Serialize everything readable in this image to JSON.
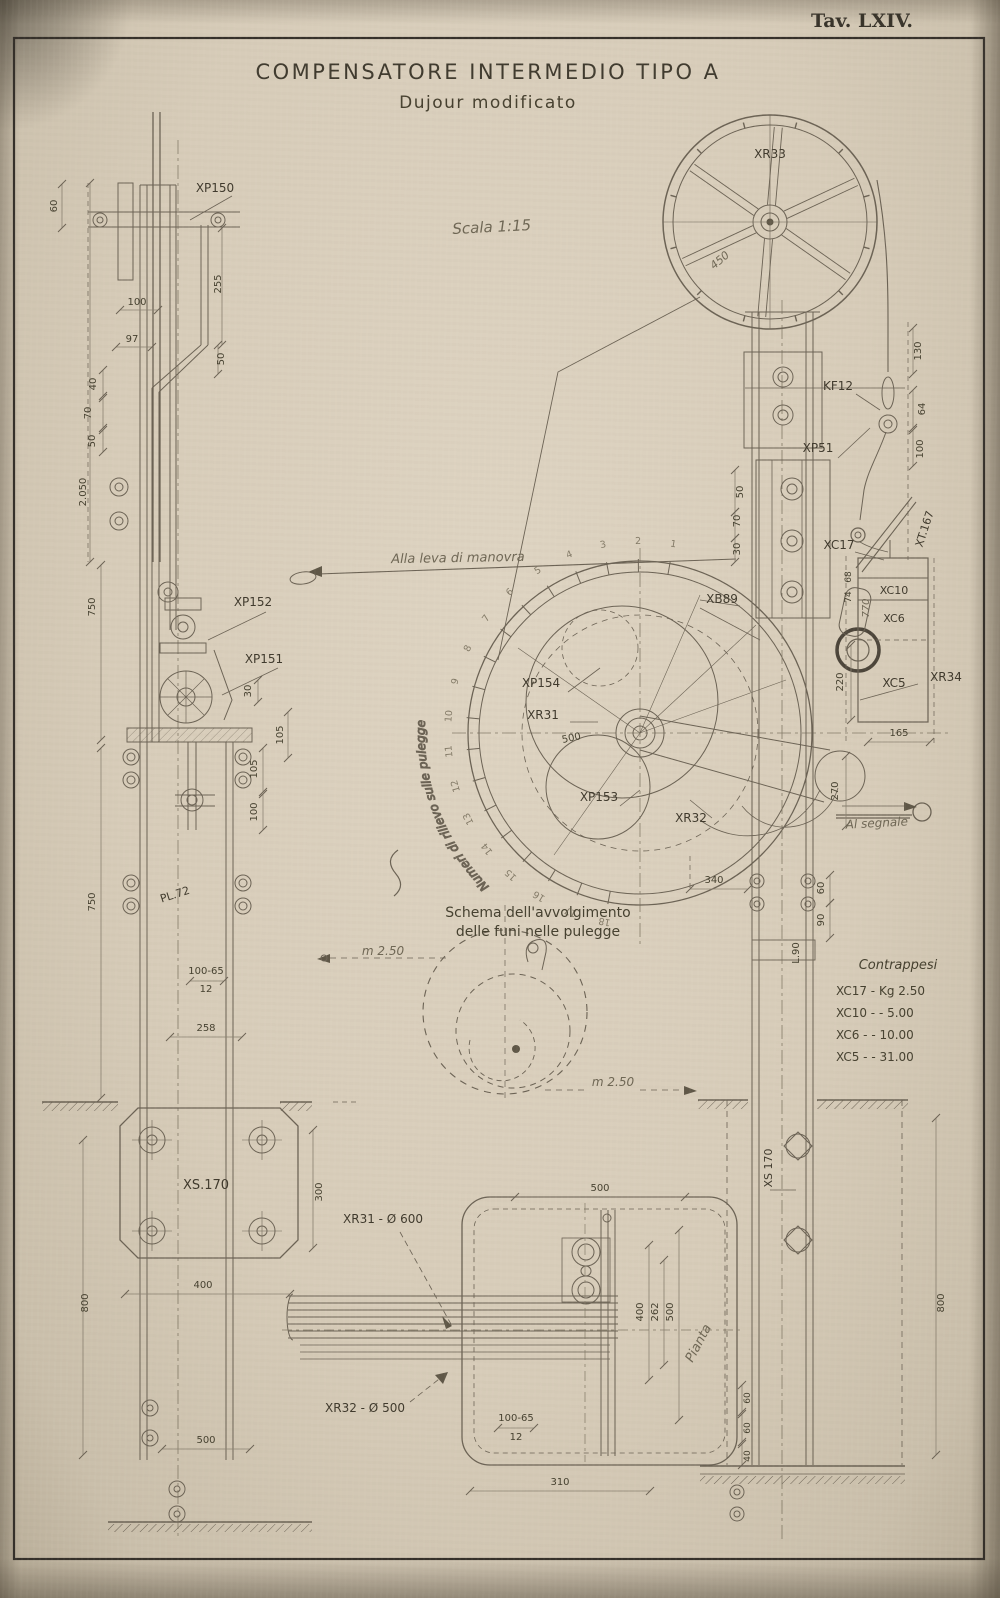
{
  "plate": {
    "number": "Tav. LXIV."
  },
  "title": {
    "line1": "COMPENSATORE INTERMEDIO TIPO A",
    "line2": "Dujour modificato",
    "scale_note": "Scala 1:15"
  },
  "colors": {
    "paper": "#d7ccb9",
    "ink": "#5f5747",
    "heavy": "#4c453a",
    "dim": "#837a67",
    "text": "#45402f",
    "frame": "#35302a"
  },
  "dial": {
    "center_x": 640,
    "center_y": 733,
    "start_angle_deg": 80,
    "step_deg": 10.55,
    "numbers": [
      "1",
      "2",
      "3",
      "4",
      "5",
      "6",
      "7",
      "8",
      "9",
      "10",
      "11",
      "12",
      "13",
      "14",
      "15",
      "16",
      "17",
      "18"
    ],
    "curved_label": "Numeri di rilievo sulle pulegge"
  },
  "contrappesi": {
    "title": "Contrappesi",
    "items": [
      {
        "code": "XC17",
        "value": "Kg 2.50"
      },
      {
        "code": "XC10",
        "value": "-  5.00"
      },
      {
        "code": "XC6",
        "value": "-  10.00"
      },
      {
        "code": "XC5",
        "value": "-  31.00"
      }
    ]
  },
  "labels": [
    {
      "n": "label-xp150",
      "t": "XP150",
      "x": 215,
      "y": 192,
      "s": 12,
      "c": "c"
    },
    {
      "n": "dim-60-left-top",
      "t": "60",
      "x": 57,
      "y": 206,
      "r": -90,
      "s": 10,
      "l": [
        62,
        184,
        62,
        228
      ]
    },
    {
      "n": "dim-255",
      "t": "255",
      "x": 221,
      "y": 284,
      "r": -90,
      "s": 10,
      "l": [
        222,
        228,
        222,
        345
      ]
    },
    {
      "n": "dim-100-left",
      "t": "100",
      "x": 137,
      "y": 305,
      "s": 10,
      "l": [
        120,
        310,
        158,
        310
      ]
    },
    {
      "n": "dim-97",
      "t": "97",
      "x": 132,
      "y": 342,
      "s": 10,
      "l": [
        116,
        347,
        152,
        347
      ]
    },
    {
      "n": "dim-50-a",
      "t": "50",
      "x": 224,
      "y": 359,
      "r": -90,
      "s": 10,
      "l": [
        218,
        345,
        218,
        374
      ]
    },
    {
      "n": "dim-40-a",
      "t": "40",
      "x": 96,
      "y": 384,
      "r": -90,
      "s": 10,
      "l": [
        103,
        370,
        103,
        396
      ]
    },
    {
      "n": "dim-70-a",
      "t": "70",
      "x": 91,
      "y": 413,
      "r": -90,
      "s": 10,
      "l": [
        103,
        398,
        103,
        428
      ]
    },
    {
      "n": "dim-50-b",
      "t": "50",
      "x": 95,
      "y": 441,
      "r": -90,
      "s": 10,
      "l": [
        103,
        430,
        103,
        452
      ]
    },
    {
      "n": "dim-2050",
      "t": "2.050",
      "x": 86,
      "y": 492,
      "r": -90,
      "s": 10,
      "l": [
        90,
        183,
        90,
        562
      ]
    },
    {
      "n": "dim-750-upper",
      "t": "750",
      "x": 95,
      "y": 607,
      "r": -90,
      "s": 10,
      "l": [
        101,
        565,
        101,
        740
      ]
    },
    {
      "n": "label-xp152",
      "t": "XP152",
      "x": 253,
      "y": 606,
      "s": 12,
      "c": "c"
    },
    {
      "n": "label-xp151",
      "t": "XP151",
      "x": 264,
      "y": 663,
      "s": 12,
      "c": "c"
    },
    {
      "n": "dim-30-mid",
      "t": "30",
      "x": 251,
      "y": 691,
      "r": -90,
      "s": 10,
      "l": [
        258,
        680,
        258,
        702
      ]
    },
    {
      "n": "dim-105-a",
      "t": "105",
      "x": 283,
      "y": 735,
      "r": -90,
      "s": 10,
      "l": [
        288,
        712,
        288,
        758
      ]
    },
    {
      "n": "dim-105-b",
      "t": "105",
      "x": 257,
      "y": 769,
      "r": -90,
      "s": 10,
      "l": [
        263,
        748,
        263,
        792
      ]
    },
    {
      "n": "dim-100-b",
      "t": "100",
      "x": 257,
      "y": 812,
      "r": -90,
      "s": 10,
      "l": [
        263,
        794,
        263,
        830
      ]
    },
    {
      "n": "dim-750-lower",
      "t": "750",
      "x": 95,
      "y": 902,
      "r": -90,
      "s": 10,
      "l": [
        101,
        748,
        101,
        1098
      ]
    },
    {
      "n": "label-pl72",
      "t": "PL.72",
      "x": 176,
      "y": 898,
      "r": -18,
      "s": 11,
      "c": "c"
    },
    {
      "n": "dim-profile-left-top",
      "t": "100-65",
      "x": 206,
      "y": 974,
      "s": 10,
      "l": [
        190,
        981,
        224,
        981
      ]
    },
    {
      "n": "dim-profile-left-bottom",
      "t": "12",
      "x": 206,
      "y": 992,
      "s": 10
    },
    {
      "n": "dim-258",
      "t": "258",
      "x": 206,
      "y": 1031,
      "s": 10,
      "l": [
        170,
        1037,
        242,
        1037
      ]
    },
    {
      "n": "label-xs170-plate",
      "t": "XS.170",
      "x": 206,
      "y": 1189,
      "s": 13,
      "c": "c"
    },
    {
      "n": "dim-300",
      "t": "300",
      "x": 322,
      "y": 1192,
      "r": -90,
      "s": 10,
      "l": [
        313,
        1130,
        313,
        1248
      ]
    },
    {
      "n": "dim-400-left",
      "t": "400",
      "x": 203,
      "y": 1288,
      "s": 10,
      "l": [
        125,
        1294,
        290,
        1294
      ]
    },
    {
      "n": "dim-800-left",
      "t": "800",
      "x": 88,
      "y": 1303,
      "r": -90,
      "s": 10,
      "l": [
        83,
        1140,
        83,
        1455
      ]
    },
    {
      "n": "dim-500-left-bottom",
      "t": "500",
      "x": 206,
      "y": 1443,
      "s": 10,
      "l": [
        162,
        1449,
        250,
        1449
      ]
    },
    {
      "n": "note-alla-leva",
      "t": "Alla leva di manovra",
      "x": 458,
      "y": 562,
      "s": 13,
      "i": 1,
      "r": -1
    },
    {
      "n": "label-xb89",
      "t": "XB89",
      "x": 722,
      "y": 603,
      "s": 12,
      "c": "c"
    },
    {
      "n": "label-xp154",
      "t": "XP154",
      "x": 541,
      "y": 687,
      "s": 12,
      "c": "c"
    },
    {
      "n": "label-xr31",
      "t": "XR31",
      "x": 543,
      "y": 719,
      "s": 12,
      "c": "c"
    },
    {
      "n": "label-xp153",
      "t": "XP153",
      "x": 599,
      "y": 801,
      "s": 12,
      "c": "c"
    },
    {
      "n": "label-xr32",
      "t": "XR32",
      "x": 691,
      "y": 822,
      "s": 12,
      "c": "c"
    },
    {
      "n": "label-xr34",
      "t": "XR34",
      "x": 946,
      "y": 681,
      "s": 12,
      "c": "c"
    },
    {
      "n": "dim-500-dial",
      "t": "500",
      "x": 572,
      "y": 741,
      "r": -12,
      "s": 10
    },
    {
      "n": "dim-340",
      "t": "340",
      "x": 714,
      "y": 883,
      "s": 10,
      "l": [
        690,
        889,
        748,
        889
      ]
    },
    {
      "n": "note-schema-1",
      "t": "Schema dell'avvolgimento",
      "x": 538,
      "y": 917,
      "s": 14
    },
    {
      "n": "note-schema-2",
      "t": "delle funi nelle pulegge",
      "x": 538,
      "y": 936,
      "s": 14
    },
    {
      "n": "dim-m250-left",
      "t": "m 2.50",
      "x": 383,
      "y": 955,
      "s": 12,
      "i": 1
    },
    {
      "n": "dim-m250-right",
      "t": "m 2.50",
      "x": 613,
      "y": 1086,
      "s": 12,
      "i": 1
    },
    {
      "n": "label-xr31-diam",
      "t": "XR31 - Ø 600",
      "x": 383,
      "y": 1223,
      "s": 12,
      "c": "c"
    },
    {
      "n": "label-xr32-diam",
      "t": "XR32 - Ø 500",
      "x": 365,
      "y": 1412,
      "s": 12,
      "c": "c"
    },
    {
      "n": "dim-profile-plan-top",
      "t": "100-65",
      "x": 516,
      "y": 1421,
      "s": 10,
      "l": [
        498,
        1428,
        534,
        1428
      ]
    },
    {
      "n": "dim-profile-plan-bottom",
      "t": "12",
      "x": 516,
      "y": 1440,
      "s": 10
    },
    {
      "n": "dim-310",
      "t": "310",
      "x": 560,
      "y": 1485,
      "s": 10,
      "l": [
        470,
        1491,
        650,
        1491
      ]
    },
    {
      "n": "dim-500-plan-top",
      "t": "500",
      "x": 600,
      "y": 1191,
      "s": 10,
      "l": [
        515,
        1197,
        685,
        1197
      ]
    },
    {
      "n": "dim-400-plan",
      "t": "400",
      "x": 643,
      "y": 1312,
      "r": -90,
      "s": 10,
      "l": [
        649,
        1245,
        649,
        1380
      ]
    },
    {
      "n": "dim-262-plan",
      "t": "262",
      "x": 658,
      "y": 1312,
      "r": -90,
      "s": 10,
      "l": [
        664,
        1260,
        664,
        1365
      ]
    },
    {
      "n": "dim-500-plan-right",
      "t": "500",
      "x": 673,
      "y": 1312,
      "r": -90,
      "s": 10,
      "l": [
        679,
        1230,
        679,
        1420
      ]
    },
    {
      "n": "note-pianta",
      "t": "Pianta",
      "x": 702,
      "y": 1345,
      "r": -62,
      "s": 13,
      "i": 1
    },
    {
      "n": "label-xr33",
      "t": "XR33",
      "x": 770,
      "y": 158,
      "s": 12,
      "c": "c"
    },
    {
      "n": "dim-450-wheel",
      "t": "450",
      "x": 722,
      "y": 263,
      "r": -40,
      "s": 11,
      "i": 1
    },
    {
      "n": "label-kf12",
      "t": "KF12",
      "x": 838,
      "y": 390,
      "s": 12,
      "c": "c"
    },
    {
      "n": "label-xp51",
      "t": "XP51",
      "x": 818,
      "y": 452,
      "s": 12,
      "c": "c"
    },
    {
      "n": "label-xt167",
      "t": "XT.167",
      "x": 928,
      "y": 530,
      "r": -72,
      "s": 11,
      "c": "c"
    },
    {
      "n": "label-xc17",
      "t": "XC17",
      "x": 839,
      "y": 549,
      "s": 12,
      "c": "c"
    },
    {
      "n": "label-xc10",
      "t": "XC10",
      "x": 894,
      "y": 594,
      "s": 11,
      "c": "c"
    },
    {
      "n": "label-xc6",
      "t": "XC6",
      "x": 894,
      "y": 622,
      "s": 11,
      "c": "c"
    },
    {
      "n": "label-xc5",
      "t": "XC5",
      "x": 894,
      "y": 687,
      "s": 12,
      "c": "c"
    },
    {
      "n": "dim-130",
      "t": "130",
      "x": 921,
      "y": 351,
      "r": -90,
      "s": 10,
      "l": [
        913,
        328,
        913,
        374
      ]
    },
    {
      "n": "dim-64",
      "t": "64",
      "x": 925,
      "y": 409,
      "r": -90,
      "s": 10,
      "l": [
        913,
        390,
        913,
        428
      ]
    },
    {
      "n": "dim-100-right",
      "t": "100",
      "x": 923,
      "y": 449,
      "r": -90,
      "s": 10,
      "l": [
        913,
        430,
        913,
        466
      ]
    },
    {
      "n": "dim-50-post",
      "t": "50",
      "x": 743,
      "y": 492,
      "r": -90,
      "s": 10,
      "l": [
        735,
        470,
        735,
        512
      ]
    },
    {
      "n": "dim-70-post",
      "t": "70",
      "x": 740,
      "y": 521,
      "r": -90,
      "s": 10,
      "l": [
        735,
        512,
        735,
        538
      ]
    },
    {
      "n": "dim-30-post",
      "t": "30",
      "x": 740,
      "y": 549,
      "r": -90,
      "s": 10,
      "l": [
        735,
        538,
        735,
        562
      ]
    },
    {
      "n": "dim-68",
      "t": "68",
      "x": 851,
      "y": 577,
      "r": -90,
      "s": 9
    },
    {
      "n": "dim-74",
      "t": "74",
      "x": 851,
      "y": 597,
      "r": -90,
      "s": 9
    },
    {
      "n": "dim-770",
      "t": "770",
      "x": 869,
      "y": 608,
      "r": -90,
      "s": 10,
      "i": 1
    },
    {
      "n": "dim-220",
      "t": "220",
      "x": 843,
      "y": 682,
      "r": -90,
      "s": 10,
      "l": [
        851,
        645,
        851,
        720
      ]
    },
    {
      "n": "dim-165",
      "t": "165",
      "x": 899,
      "y": 736,
      "s": 10,
      "l": [
        868,
        742,
        930,
        742
      ]
    },
    {
      "n": "dim-270",
      "t": "270",
      "x": 838,
      "y": 791,
      "r": -90,
      "s": 10,
      "l": [
        846,
        756,
        846,
        826
      ]
    },
    {
      "n": "note-al-segnale",
      "t": "Al segnale",
      "x": 877,
      "y": 827,
      "s": 12,
      "i": 1,
      "r": -3
    },
    {
      "n": "dim-60-post",
      "t": "60",
      "x": 824,
      "y": 888,
      "r": -90,
      "s": 10,
      "l": [
        830,
        875,
        830,
        903
      ]
    },
    {
      "n": "dim-90-post",
      "t": "90",
      "x": 824,
      "y": 920,
      "r": -90,
      "s": 10,
      "l": [
        830,
        903,
        830,
        938
      ]
    },
    {
      "n": "dim-l90",
      "t": "L.90",
      "x": 799,
      "y": 953,
      "r": -90,
      "s": 10
    },
    {
      "n": "label-xs170-right",
      "t": "XS 170",
      "x": 772,
      "y": 1168,
      "r": -90,
      "s": 11,
      "c": "c"
    },
    {
      "n": "dim-800-right",
      "t": "800",
      "x": 944,
      "y": 1303,
      "r": -90,
      "s": 10,
      "l": [
        936,
        1118,
        936,
        1455
      ]
    },
    {
      "n": "dim-60-base-a",
      "t": "60",
      "x": 750,
      "y": 1398,
      "r": -90,
      "s": 9,
      "l": [
        742,
        1385,
        742,
        1412
      ]
    },
    {
      "n": "dim-60-base-b",
      "t": "60",
      "x": 750,
      "y": 1428,
      "r": -90,
      "s": 9,
      "l": [
        742,
        1414,
        742,
        1442
      ]
    },
    {
      "n": "dim-40-base",
      "t": "40",
      "x": 750,
      "y": 1456,
      "r": -90,
      "s": 9,
      "l": [
        742,
        1444,
        742,
        1465
      ]
    }
  ]
}
